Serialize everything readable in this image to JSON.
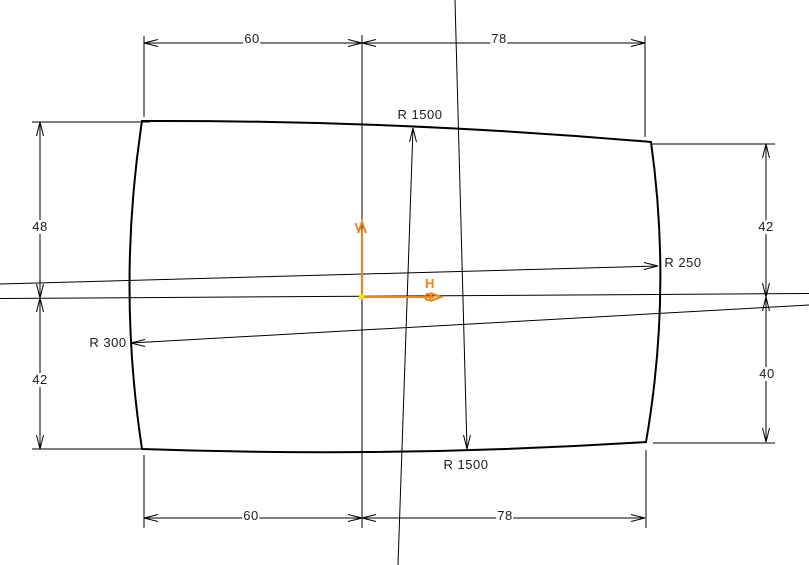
{
  "diagram": {
    "background_color": "#ffffff",
    "line_color": "#000000",
    "dimensions": {
      "top_width_left": "60",
      "top_width_right": "78",
      "bottom_width_left": "60",
      "bottom_width_right": "78",
      "left_height_upper": "48",
      "left_height_lower": "42",
      "right_height_upper": "42",
      "right_height_lower": "40"
    },
    "radii": {
      "top_arc": "R 1500",
      "bottom_arc": "R 1500",
      "left_arc": "R 300",
      "right_arc": "R 250"
    },
    "axes": {
      "horizontal_label": "H",
      "vertical_label": "V",
      "color": "#f88011",
      "origin_color": "#ffe600"
    }
  }
}
